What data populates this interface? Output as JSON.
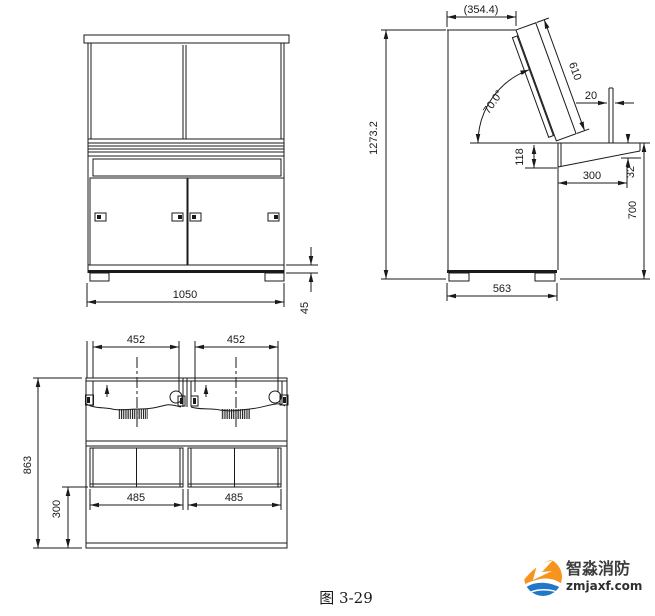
{
  "meta": {
    "caption": "图 3-29"
  },
  "logo": {
    "name": "智淼消防",
    "site": "zmjaxf.com",
    "orange": "#f7941d",
    "blue": "#2277c8"
  },
  "dims": {
    "front_width": "1050",
    "front_foot": "45",
    "side_top_depth": "(354.4)",
    "side_panel_length": "610",
    "side_panel_angle": "70.0°",
    "side_lip": "20",
    "side_drop": "118",
    "side_overhang": "300",
    "side_edge": "32",
    "side_desk_height": "700",
    "side_total_height": "1273.2",
    "side_depth": "563",
    "plan_module_1": "452",
    "plan_module_2": "452",
    "plan_opening_1": "485",
    "plan_opening_2": "485",
    "plan_depth": "863",
    "plan_rear": "300"
  }
}
